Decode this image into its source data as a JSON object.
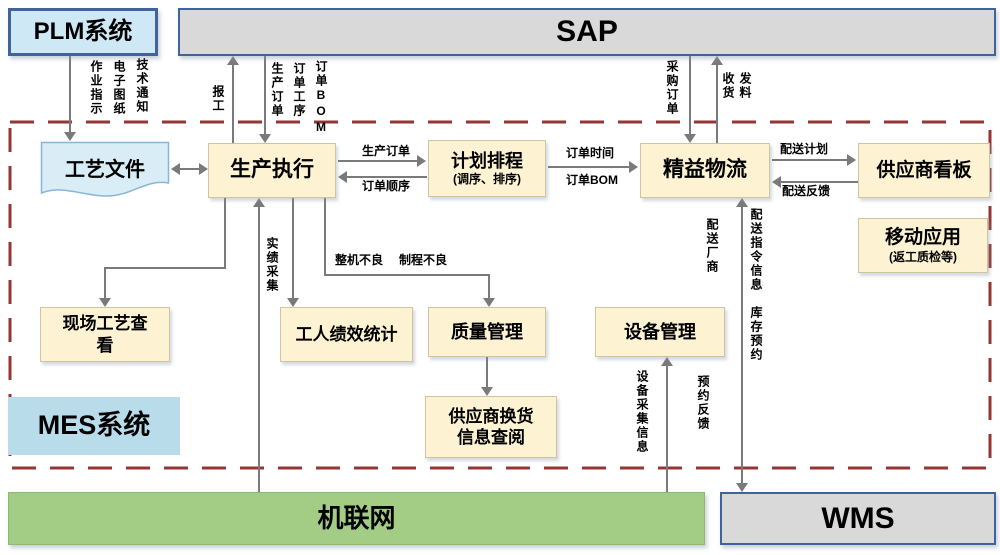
{
  "nodes": {
    "plm": "PLM系统",
    "sap": "SAP",
    "process_file": "工艺文件",
    "production_exec": "生产执行",
    "scheduling_title": "计划排程",
    "scheduling_sub": "(调序、排序)",
    "lean_logistics": "精益物流",
    "supplier_kanban": "供应商看板",
    "mobile_app_title": "移动应用",
    "mobile_app_sub": "(返工质检等)",
    "onsite_process_view": "现场工艺查看",
    "worker_performance": "工人绩效统计",
    "quality_mgmt": "质量管理",
    "equipment_mgmt": "设备管理",
    "supplier_exchange": "供应商换货信息查阅",
    "mes_region": "MES系统",
    "machine_network": "机联网",
    "wms": "WMS"
  },
  "flows": {
    "work_instruction": "作业指示",
    "e_drawing": "电子图纸",
    "tech_notice": "技术通知",
    "work_report": "报工",
    "production_order_down": "生产订单",
    "order_process": "订单工序",
    "order_bom_down": "订单BOM",
    "production_order": "生产订单",
    "order_sequence": "订单顺序",
    "order_time": "订单时间",
    "order_bom": "订单BOM",
    "purchase_order": "采购订单",
    "goods_receipt": "收货",
    "material_issue": "发料",
    "delivery_plan": "配送计划",
    "delivery_feedback": "配送反馈",
    "actual_collection": "实绩采集",
    "machine_defect": "整机不良",
    "process_defect": "制程不良",
    "delivery_vendor": "配送厂商",
    "delivery_instruction_info": "配送指令信息",
    "inventory_reservation": "库存预约",
    "reservation_feedback": "预约反馈",
    "equipment_data_collection": "设备采集信息"
  },
  "colors": {
    "yellow_box": "#fdf3d2",
    "blue_box": "#cfe8f5",
    "gray_box": "#d9d9d9",
    "green_box": "#a3cc85",
    "mes_label_bg": "#b9dcea",
    "boundary_red": "#943634",
    "arrow_gray": "#7a7a7a"
  }
}
